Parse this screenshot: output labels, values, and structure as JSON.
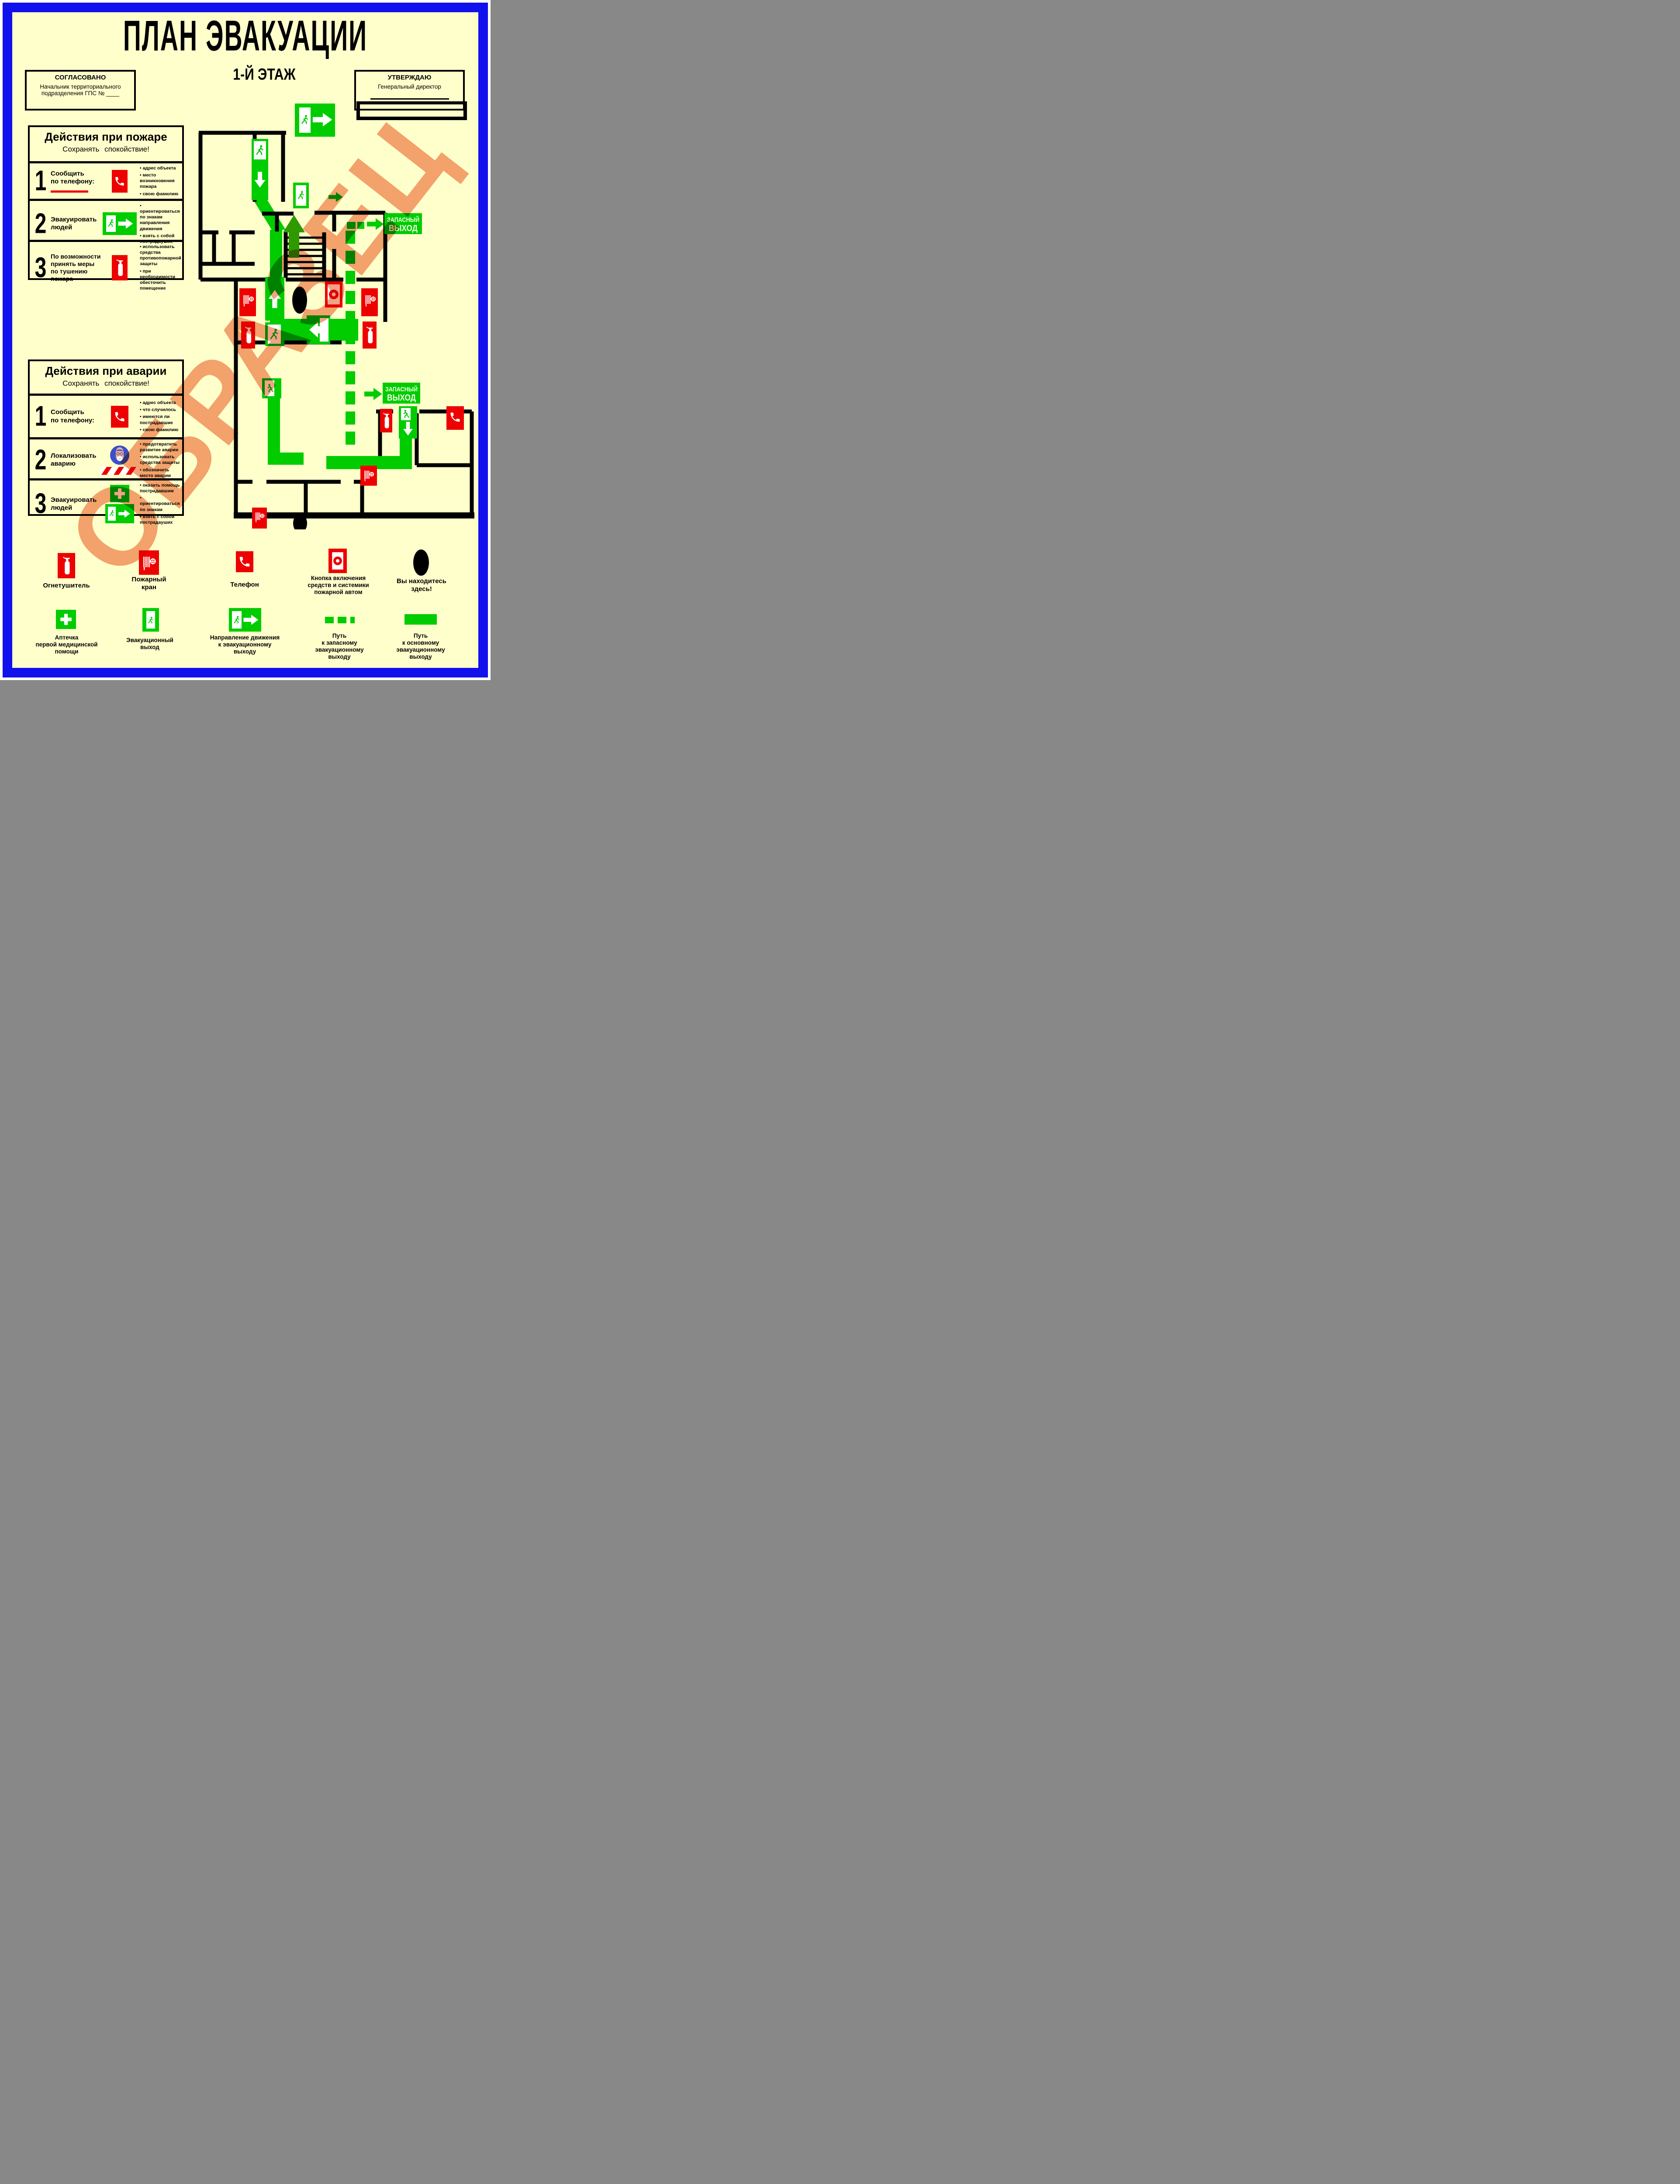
{
  "title": "ПЛАН ЭВАКУАЦИИ",
  "floor": "1-Й ЭТАЖ",
  "watermark": "ОБРАЗЕЦ",
  "colors": {
    "background": "#FFFFCC",
    "frame_blue": "#1111EE",
    "sign_green": "#00CC00",
    "sign_red": "#EE0000",
    "watermark_salmon": "#F2A285"
  },
  "agreed_box": {
    "title": "СОГЛАСОВАНО",
    "lines": [
      "Начальник территориального",
      "подразделения ГПС № ____"
    ]
  },
  "approved_box": {
    "title": "УТВЕРЖДАЮ",
    "lines": [
      "Генеральный директор"
    ]
  },
  "fire_panel": {
    "title": "Действия при пожаре",
    "subtitle": "Сохранять  спокойствие!",
    "steps": [
      {
        "num": "1",
        "label_lines": [
          "Сообщить",
          "по телефону:"
        ],
        "icon": "phone-sign",
        "bullets": [
          "адрес объекта",
          "место возникновения пожара",
          "свою фамилию"
        ]
      },
      {
        "num": "2",
        "label_lines": [
          "Эвакуировать",
          "людей"
        ],
        "icon": "exit-sign-with-arrow",
        "bullets": [
          "ориентироваться по знакам направления движения",
          "взять с собой пострадауших"
        ]
      },
      {
        "num": "3",
        "label_lines": [
          "По возможности",
          "принять меры",
          "по тушению",
          "пожара"
        ],
        "icon": "extinguisher-sign",
        "bullets": [
          "использовать средства противопожарной защиты",
          "при необходимости обесточить помещение"
        ]
      }
    ]
  },
  "accident_panel": {
    "title": "Действия при аварии",
    "subtitle": "Сохранять  спокойствие!",
    "steps": [
      {
        "num": "1",
        "label_lines": [
          "Сообщить",
          "по телефону:"
        ],
        "icon": "phone-sign",
        "bullets": [
          "адрес объекта",
          "что случилось",
          "имеются ли пострадавшие",
          "свою фамилию"
        ]
      },
      {
        "num": "2",
        "label_lines": [
          "Локализовать",
          "аварию"
        ],
        "icon": "respirator-sign-and-hazard-stripe",
        "bullets": [
          "предотвратить развитие аварии",
          "использовать средства защиты",
          "обозначить место аварии"
        ]
      },
      {
        "num": "3",
        "label_lines": [
          "Эвакуировать",
          "людей"
        ],
        "icon": "first-aid-sign-and-exit-sign",
        "bullets": [
          "оказать помощь пострадавшим",
          "ориентироваться по знакам",
          "взять с собой пострадауших"
        ]
      }
    ]
  },
  "plan": {
    "exit_sign_line1": "ЗАПАСНЫЙ",
    "exit_sign_line2": "ВЫХОД"
  },
  "legend": {
    "row1": [
      {
        "label_lines": [
          "Огнетушитель"
        ]
      },
      {
        "label_lines": [
          "Пожарный",
          "кран"
        ]
      },
      {
        "label_lines": [
          "Телефон"
        ]
      },
      {
        "label_lines": [
          "Кнопка включения",
          "средств и системики",
          "пожарной автом"
        ]
      },
      {
        "label_lines": [
          "Вы находитесь",
          "здесь!"
        ]
      }
    ],
    "row2": [
      {
        "label_lines": [
          "Аптечка",
          "первой медицинской",
          "помощи"
        ]
      },
      {
        "label_lines": [
          "Эвакуационный",
          "выход"
        ]
      },
      {
        "label_lines": [
          "Направление движения",
          "к эвакуационному",
          "выходу"
        ]
      },
      {
        "label_lines": [
          "Путь",
          "к запасному",
          "эвакуационному",
          "выходу"
        ]
      },
      {
        "label_lines": [
          "Путь",
          "к основному",
          "эвакуационному",
          "выходу"
        ]
      }
    ]
  }
}
